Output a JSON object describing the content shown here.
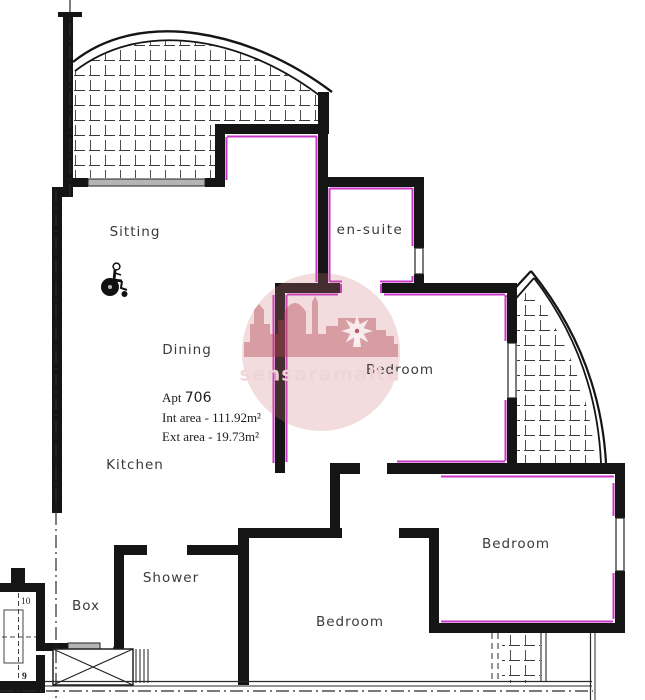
{
  "floor_plan": {
    "labels": {
      "sitting": "Sitting",
      "dining": "Dining",
      "kitchen": "Kitchen",
      "ensuite": "en-suite",
      "bedroom_top_right": "Bedroom",
      "bedroom_bottom_right": "Bedroom",
      "bedroom_bottom_center": "Bedroom",
      "shower": "Shower",
      "box": "Box"
    },
    "apartment_info": {
      "apt_label": "Apt",
      "apt_number": "706",
      "int_area": "Int area - 111.92m²",
      "ext_area": "Ext area - 19.73m²"
    },
    "stairs": {
      "step_top": "10",
      "step_bottom": "9"
    },
    "watermark": {
      "text": "sensaramalta"
    },
    "icons": {
      "wheelchair": "wheelchair-accessibility-icon",
      "windmill": "windmill-icon",
      "skyline": "malta-skyline-silhouette"
    },
    "colors": {
      "wall": "#151515",
      "insulation_magenta": "#c837c8",
      "watermark_rose": "#c05a68",
      "window_gray": "#b5b5b5"
    }
  }
}
